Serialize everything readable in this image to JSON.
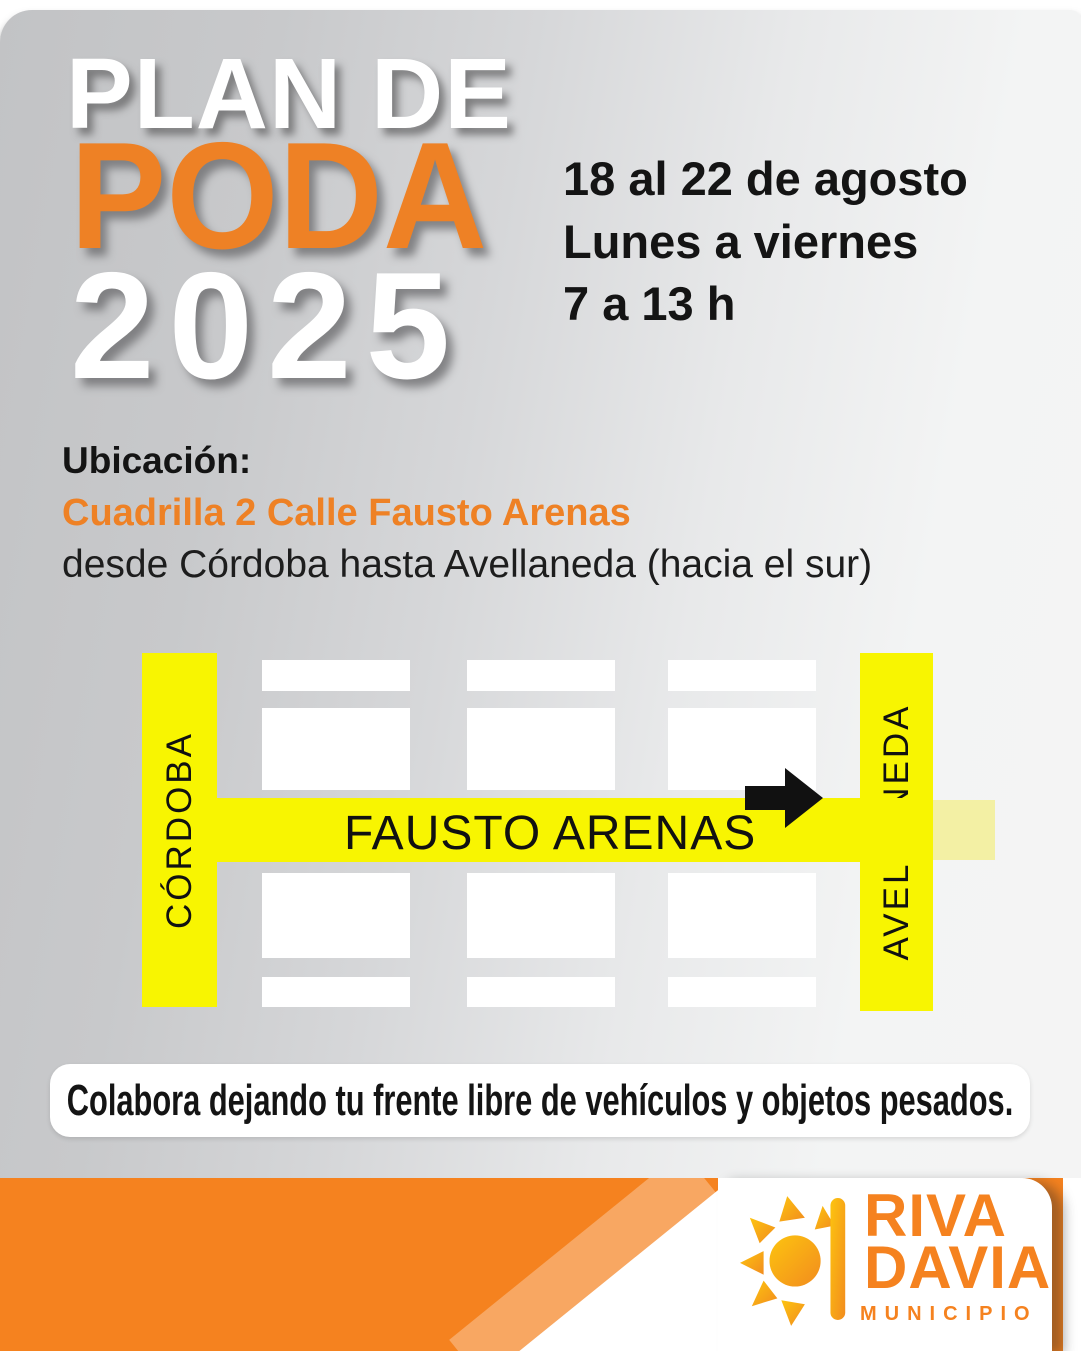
{
  "title": {
    "line1": "PLAN DE",
    "line2": "PODA",
    "line3": "2025"
  },
  "schedule": {
    "dates": "18 al 22 de agosto",
    "days": "Lunes a viernes",
    "hours": "7 a 13 h"
  },
  "location": {
    "label": "Ubicación:",
    "crew": "Cuadrilla 2 Calle Fausto Arenas",
    "detail": "desde Córdoba hasta Avellaneda (hacia el sur)"
  },
  "map": {
    "street_left": "CÓRDOBA",
    "street_right": "AVELLANEDA",
    "street_main": "FAUSTO ARENAS",
    "arrow_icon": "right-arrow",
    "street_color": "#F8F501"
  },
  "banner": {
    "text": "Colabora dejando tu frente libre de vehículos y objetos pesados."
  },
  "footer": {
    "logo_line1": "RIVA",
    "logo_line2": "DAVIA",
    "logo_sub": "MUNICIPIO",
    "sun_icon": "sun-icon",
    "band_color": "#F5821F"
  },
  "colors": {
    "accent_orange": "#EE8125",
    "footer_orange": "#F5821F",
    "street_yellow": "#F8F501",
    "title_white": "#FFFFFF",
    "text_black": "#141414"
  }
}
